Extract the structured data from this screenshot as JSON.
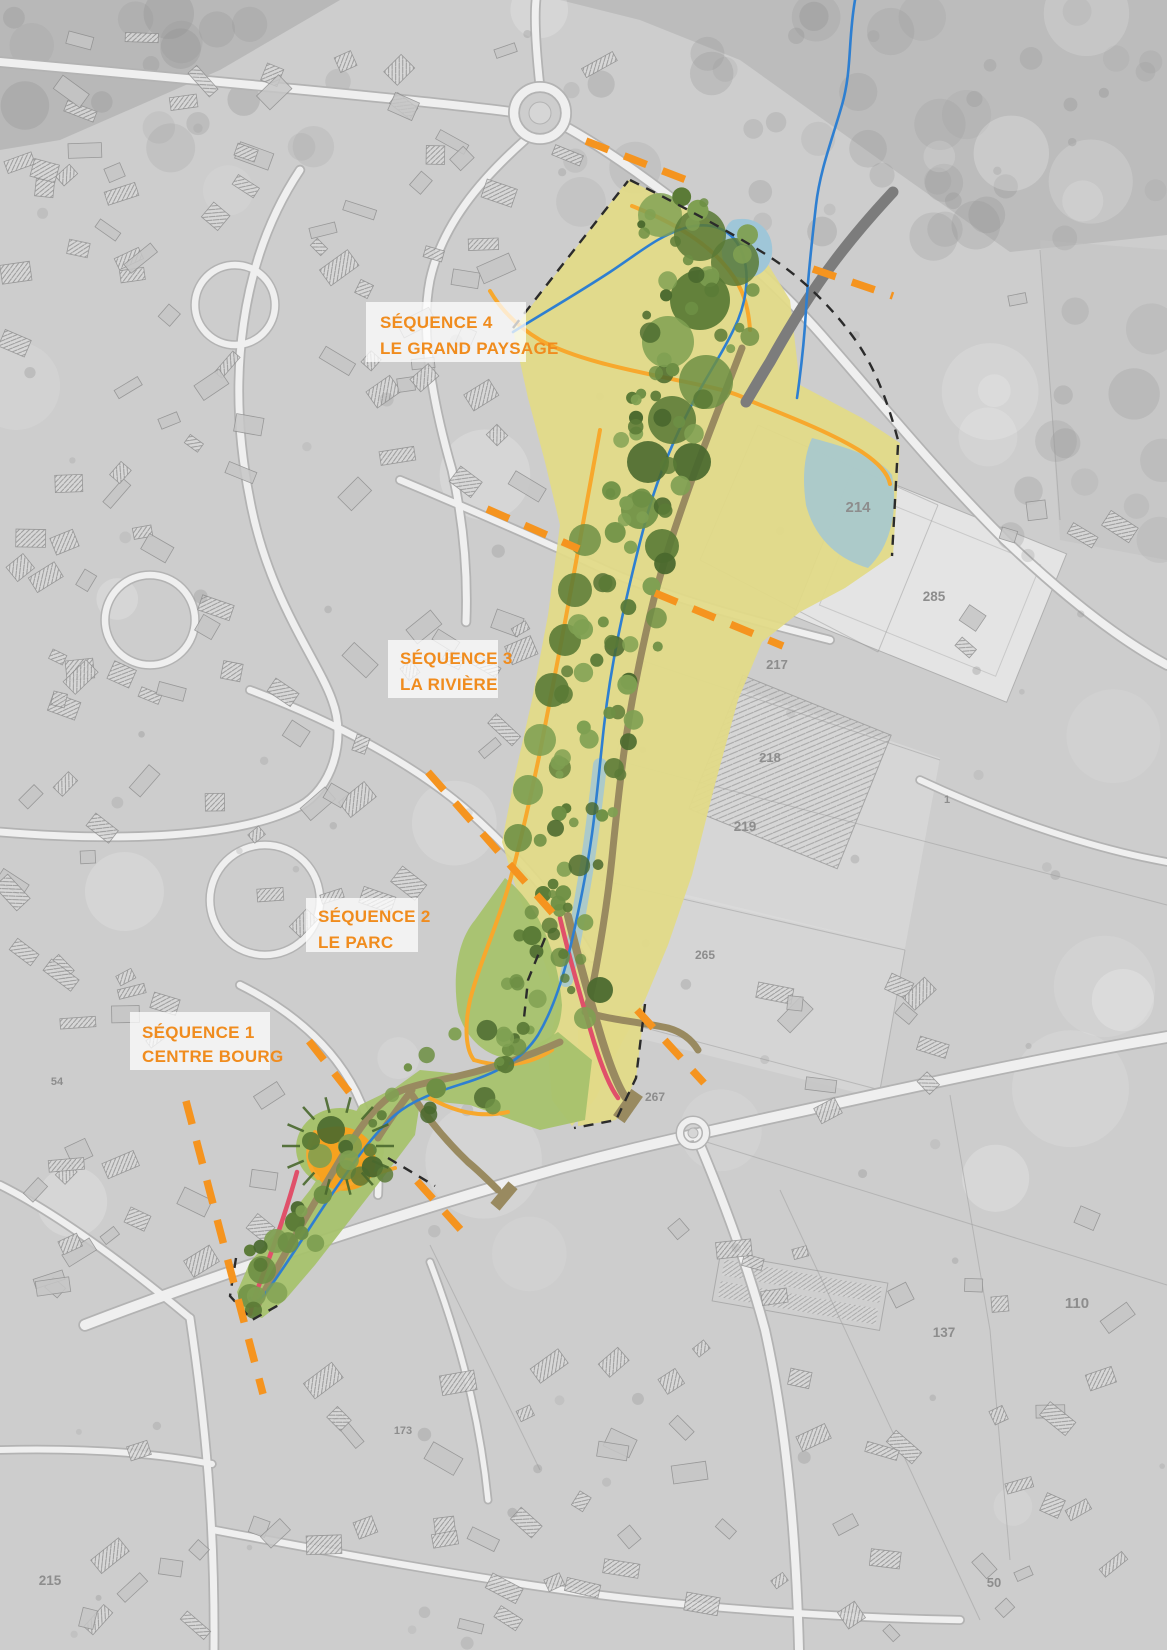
{
  "map": {
    "sequences": [
      {
        "id": 4,
        "line1": "SÉQUENCE 4",
        "line2": "LE GRAND PAYSAGE"
      },
      {
        "id": 3,
        "line1": "SÉQUENCE 3",
        "line2": "LA RIVIÈRE"
      },
      {
        "id": 2,
        "line1": "SÉQUENCE 2",
        "line2": "LE PARC"
      },
      {
        "id": 1,
        "line1": "SÉQUENCE 1",
        "line2": "CENTRE BOURG"
      }
    ],
    "parcel_labels": [
      {
        "label": "214"
      },
      {
        "label": "285"
      },
      {
        "label": "217"
      },
      {
        "label": "218"
      },
      {
        "label": "219"
      },
      {
        "label": "265"
      },
      {
        "label": "267"
      },
      {
        "label": "1"
      },
      {
        "label": "110"
      },
      {
        "label": "137"
      },
      {
        "label": "54"
      },
      {
        "label": "173"
      },
      {
        "label": "215"
      },
      {
        "label": "50"
      }
    ]
  },
  "colors": {
    "accent_orange": "#F08C1E",
    "separator_orange": "#F5941F",
    "corridor_yellow": "#E1DA88",
    "park_green": "#A7C26D",
    "tree_green": "#5A7A36",
    "river_blue": "#2E7FD1",
    "water_light": "#9FC6D8",
    "path_orange": "#F7A82D",
    "path_brown": "#998A60",
    "line_red": "#E0506A",
    "road_gray": "#7C7C7C",
    "label_gray": "#8D8D8D"
  }
}
